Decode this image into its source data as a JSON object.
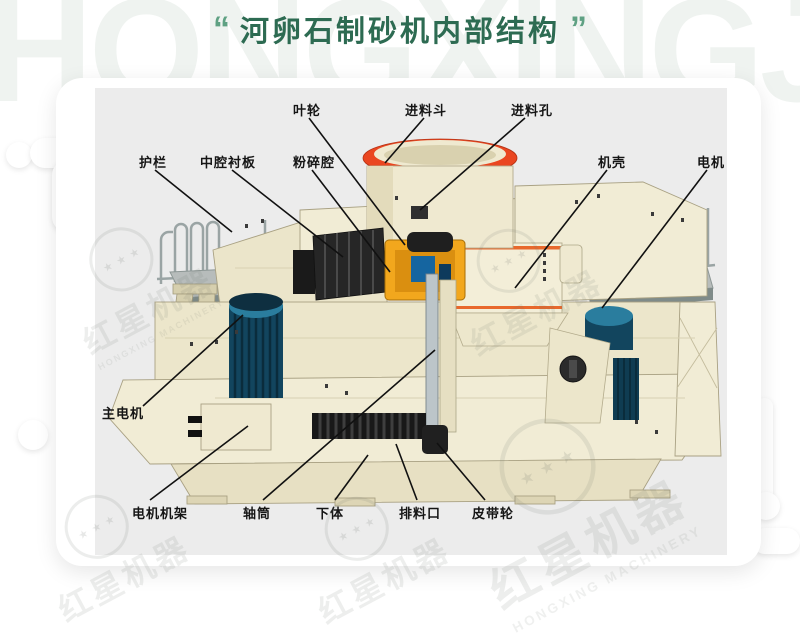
{
  "title": {
    "quote_open": "“",
    "text": "河卵石制砂机内部结构",
    "quote_close": "”"
  },
  "watermark": {
    "letters": "HONGXINGJIQI",
    "stars": "★ ★ ★",
    "badge_cn": "红星机器",
    "badge_en": "HONGXING MACHINERY"
  },
  "colors": {
    "title_green": "#2d6b52",
    "quote_green": "#5fa183",
    "panel_gray": "#ececec",
    "machine_cream": "#f1ecd5",
    "accent_red": "#ea4620",
    "accent_orange_stripe": "#e8682c",
    "accent_yellow": "#f2a71d",
    "motor_teal": "#12455e",
    "leader_line": "#111111"
  },
  "diagram": {
    "callouts": [
      {
        "id": "yelun",
        "text": "叶轮",
        "cx": 212,
        "top": 12,
        "line": [
          214,
          30,
          310,
          157
        ]
      },
      {
        "id": "jinliaodou",
        "text": "进料斗",
        "cx": 331,
        "top": 12,
        "line": [
          329,
          30,
          290,
          75
        ]
      },
      {
        "id": "jinliaokong",
        "text": "进料孔",
        "cx": 437,
        "top": 12,
        "line": [
          430,
          30,
          325,
          122
        ]
      },
      {
        "id": "hulan",
        "text": "护栏",
        "cx": 58,
        "top": 64,
        "line": [
          60,
          82,
          137,
          144
        ]
      },
      {
        "id": "zhongqiangchenban",
        "text": "中腔衬板",
        "cx": 133,
        "top": 64,
        "line": [
          137,
          82,
          248,
          169
        ]
      },
      {
        "id": "fensuiqiang",
        "text": "粉碎腔",
        "cx": 219,
        "top": 64,
        "line": [
          217,
          82,
          295,
          184
        ]
      },
      {
        "id": "jike",
        "text": "机壳",
        "cx": 517,
        "top": 64,
        "line": [
          512,
          82,
          420,
          200
        ]
      },
      {
        "id": "dianji",
        "text": "电机",
        "cx": 616,
        "top": 64,
        "line": [
          612,
          82,
          507,
          220
        ]
      },
      {
        "id": "zhudianji",
        "text": "主电机",
        "cx": 28,
        "top": 315,
        "line": [
          48,
          318,
          148,
          227
        ]
      },
      {
        "id": "dianjijijia",
        "text": "电机机架",
        "cx": 65,
        "top": 415,
        "line": [
          55,
          412,
          153,
          338
        ]
      },
      {
        "id": "zhoutong",
        "text": "轴筒",
        "cx": 162,
        "top": 415,
        "line": [
          168,
          412,
          340,
          262
        ]
      },
      {
        "id": "xiati",
        "text": "下体",
        "cx": 235,
        "top": 415,
        "line": [
          240,
          412,
          273,
          367
        ]
      },
      {
        "id": "pailiaokou",
        "text": "排料口",
        "cx": 325,
        "top": 415,
        "line": [
          322,
          412,
          301,
          356
        ]
      },
      {
        "id": "pidailun",
        "text": "皮带轮",
        "cx": 398,
        "top": 415,
        "line": [
          390,
          412,
          342,
          355
        ]
      }
    ]
  }
}
